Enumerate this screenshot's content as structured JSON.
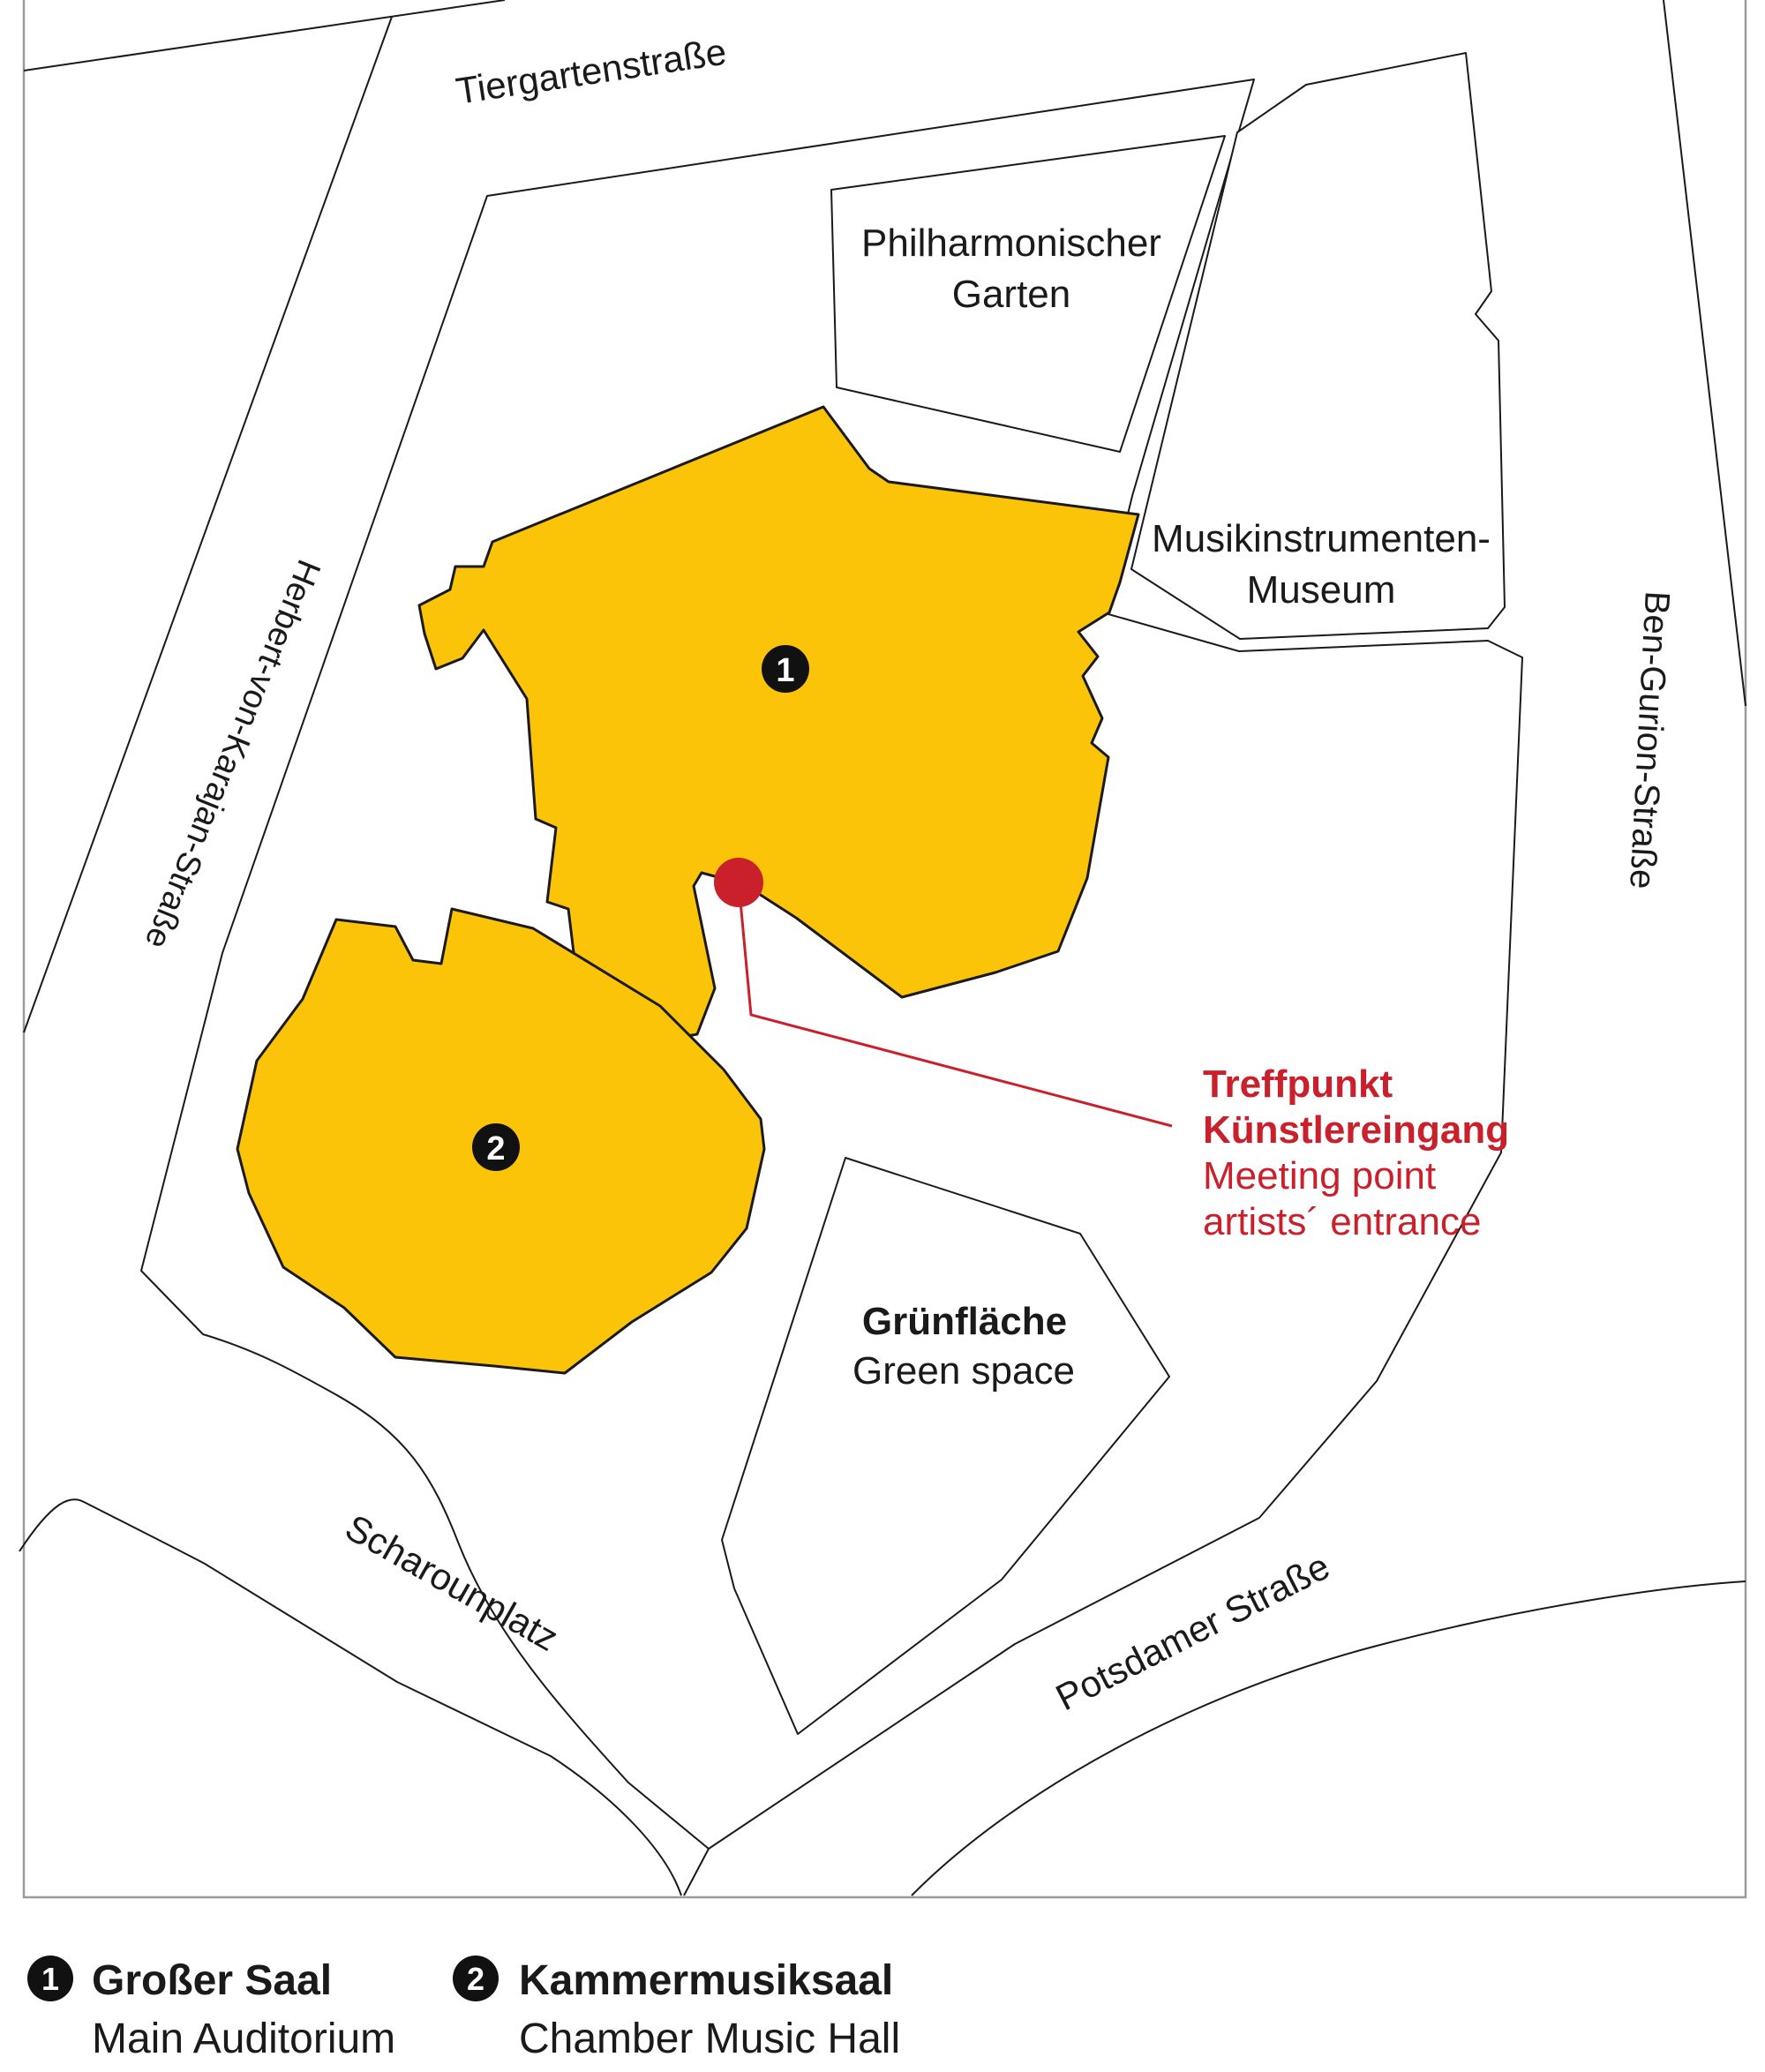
{
  "map": {
    "streets": {
      "tiergartenstrasse": "Tiergartenstraße",
      "herbert_von_karajan": "Herbert-von-Karajan-Straße",
      "ben_gurion": "Ben-Gurion-Straße",
      "scharounplatz": "Scharounplatz",
      "potsdamer": "Potsdamer Straße"
    },
    "areas": {
      "garden": {
        "lines": [
          "Philharmonischer",
          "Garten"
        ]
      },
      "museum": {
        "lines": [
          "Musikinstrumenten-",
          "Museum"
        ]
      },
      "green": {
        "title": "Grünfläche",
        "subtitle": "Green space"
      }
    },
    "markers": {
      "building1_number": "1",
      "building2_number": "2"
    },
    "annotation": {
      "line1": "Treffpunkt",
      "line2": "Künstlereingang",
      "line3": "Meeting point",
      "line4": "artists´ entrance"
    }
  },
  "legend": {
    "items": [
      {
        "number": "1",
        "title": "Großer Saal",
        "subtitle": "Main Auditorium"
      },
      {
        "number": "2",
        "title": "Kammermusiksaal",
        "subtitle": "Chamber Music Hall"
      }
    ]
  },
  "colors": {
    "building_yellow": "#FCC408",
    "marker_red": "#C9202B",
    "line_black": "#1a1a1a",
    "frame_gray": "#9b9b9b"
  }
}
